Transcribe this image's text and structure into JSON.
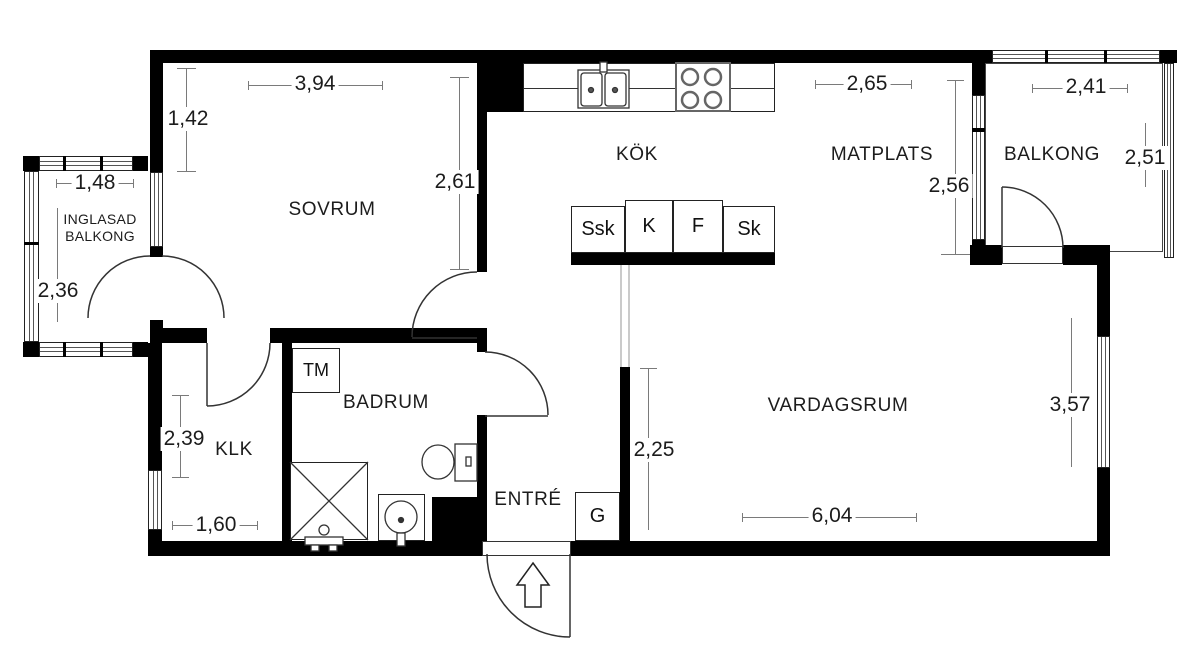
{
  "title": "Apartment floor plan",
  "colors": {
    "wall": "#000000",
    "outline": "#333333",
    "dimension_line": "#7a7a7a",
    "text": "#1c1c1c",
    "passage_line": "#b8b8b8"
  },
  "rooms": {
    "sovrum": {
      "label": "SOVRUM"
    },
    "kok": {
      "label": "KÖK"
    },
    "matplats": {
      "label": "MATPLATS"
    },
    "balkong": {
      "label": "BALKONG"
    },
    "inglasad_balkong": {
      "label": "INGLASAD\nBALKONG"
    },
    "klk": {
      "label": "KLK"
    },
    "badrum": {
      "label": "BADRUM"
    },
    "entre": {
      "label": "ENTRÉ"
    },
    "vardagsrum": {
      "label": "VARDAGSRUM"
    }
  },
  "fixtures": {
    "tvattmaskin": "TM",
    "garderob": "G",
    "ssk": "Ssk",
    "kyl": "K",
    "frys": "F",
    "skap": "Sk"
  },
  "dimensions": {
    "sovrum_width": "3,94",
    "sovrum_recess": "1,42",
    "sovrum_depth": "2,61",
    "inglasad_width": "1,48",
    "inglasad_depth": "2,36",
    "klk_depth": "2,39",
    "klk_width": "1,60",
    "matplats_width": "2,65",
    "matplats_depth": "2,56",
    "balkong_width": "2,41",
    "balkong_depth": "2,51",
    "hall_depth": "2,25",
    "vardagsrum_width": "6,04",
    "vardagsrum_depth": "3,57"
  }
}
